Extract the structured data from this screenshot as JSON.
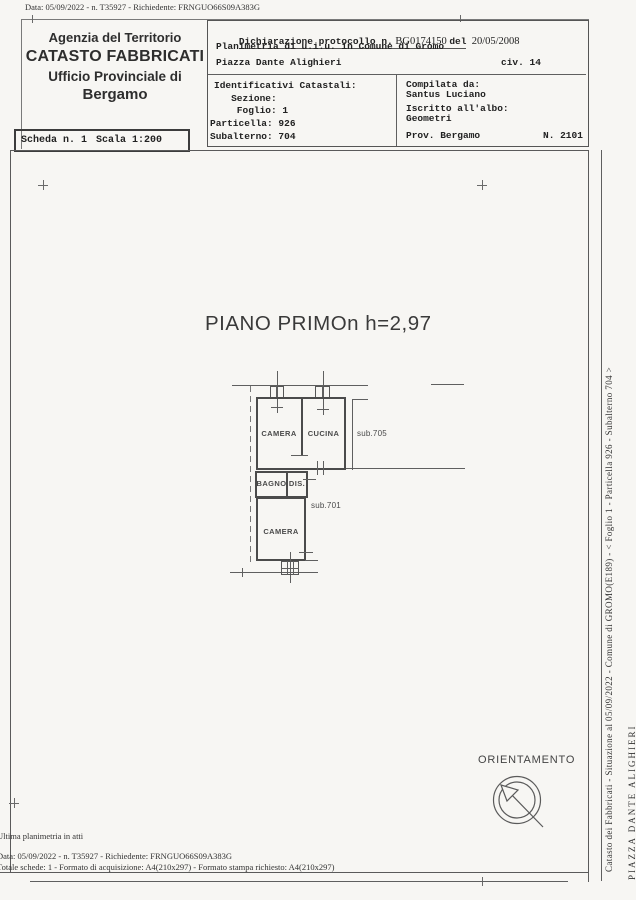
{
  "colors": {
    "paper": "#f7f6f3",
    "line": "#5a5a5a",
    "text": "#222222"
  },
  "page": {
    "top_margin_text": "Data: 05/09/2022 - n. T35927 - Richiedente: FRNGUO66S09A383G",
    "bottom": {
      "line1": "Ultima planimetria in atti",
      "line2": "Data: 05/09/2022 - n. T35927 - Richiedente: FRNGUO66S09A383G",
      "line3": "Totale schede: 1 - Formato di acquisizione: A4(210x297)  - Formato stampa richiesto: A4(210x297)"
    },
    "side_text1": "Catasto dei Fabbricati - Situazione al 05/09/2022 - Comune di GROMO(E189) - < Foglio 1 - Particella 926 - Subalterno 704 >",
    "side_text2": "PIAZZA DANTE ALIGHIERI"
  },
  "header": {
    "agency": {
      "line1": "Agenzia del Territorio",
      "line2": "CATASTO FABBRICATI",
      "line3": "Ufficio Provinciale di",
      "line4": "Bergamo"
    },
    "declaration": {
      "label": "Dichiarazione protocollo n.",
      "number": " BG0174150 ",
      "del": "del",
      "date": "  20/05/2008"
    },
    "planimetria": "Planimetria di u.i.u. in Comune di Gromo",
    "address": "Piazza Dante Alighieri",
    "civ": "civ. 14",
    "identifiers": {
      "title": "Identificativi Catastali:",
      "sezione": "   Sezione:",
      "foglio": "    Foglio: 1",
      "particella": "Particella: 926",
      "subalterno": "Subalterno: 704"
    },
    "compiler": {
      "label": "Compilata da:",
      "name": "Santus Luciano",
      "albo_label": "Iscritto all'albo:",
      "albo": "Geometri",
      "prov": "Prov. Bergamo",
      "number": "N. 2101"
    },
    "scheda": "Scheda n. 1",
    "scala": "Scala 1:200"
  },
  "plan": {
    "title": "PIANO PRIMOn h=2,97",
    "rooms": {
      "camera_upper": "CAMERA",
      "cucina": "CUCINA",
      "sub705": "sub.705",
      "bagno": "BAGNO",
      "dis": "DIS.",
      "sub701": "sub.701",
      "camera_lower": "CAMERA"
    },
    "orientation_label": "ORIENTAMENTO"
  }
}
